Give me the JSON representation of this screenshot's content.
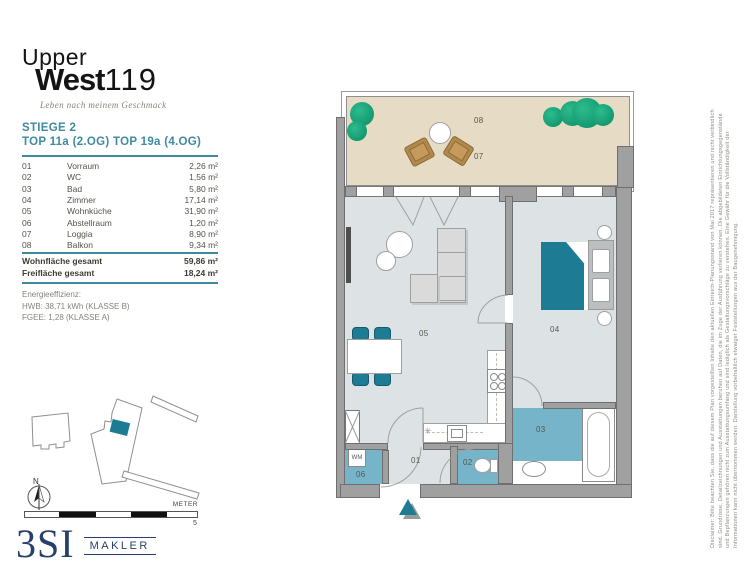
{
  "branding": {
    "word1": "Upper",
    "word2": "West",
    "number": "119",
    "tagline": "Leben nach meinem Geschmack"
  },
  "header": {
    "stiege": "STIEGE 2",
    "top_line": "TOP 11a (2.OG) TOP 19a (4.OG)"
  },
  "room_table": {
    "rows": [
      {
        "no": "01",
        "name": "Vorraum",
        "area": "2,26 m²"
      },
      {
        "no": "02",
        "name": "WC",
        "area": "1,56 m²"
      },
      {
        "no": "03",
        "name": "Bad",
        "area": "5,80 m²"
      },
      {
        "no": "04",
        "name": "Zimmer",
        "area": "17,14 m²"
      },
      {
        "no": "05",
        "name": "Wohnküche",
        "area": "31,90 m²"
      },
      {
        "no": "06",
        "name": "Abstellraum",
        "area": "1,20 m²"
      },
      {
        "no": "07",
        "name": "Loggia",
        "area": "8,90 m²"
      },
      {
        "no": "08",
        "name": "Balkon",
        "area": "9,34 m²"
      }
    ]
  },
  "totals": {
    "rows": [
      {
        "label": "Wohnfläche gesamt",
        "value": "59,86 m²"
      },
      {
        "label": "Freifläche gesamt",
        "value": "18,24 m²"
      }
    ]
  },
  "energy": {
    "title": "Energieeffizienz:",
    "line1": "HWB: 38,71 kWh (KLASSE B)",
    "line2": "FGEE: 1,28 (KLASSE A)"
  },
  "plan_labels": {
    "l01": "01",
    "l02": "02",
    "l03": "03",
    "l04": "04",
    "l05": "05",
    "l06": "06",
    "l07": "07",
    "l08": "08",
    "wm": "WM"
  },
  "compass": {
    "north": "N"
  },
  "scale_bar": {
    "unit": "METER",
    "max": "5"
  },
  "broker": {
    "name": "3SI",
    "suffix": "MAKLER"
  },
  "disclaimer": {
    "line1": "Disclaimer: Bitte beachten Sie, dass die auf diesem Plan vorgestellten Inhalte den aktuellen Einreich-Planungsstand von Mai 2017 repräsentieren und nicht verbindlich",
    "line2": "sind. Grundrisse, Detailzeichnungen und Ausstattungen beruhen auf Daten, die im Zuge der Ausführung verlieren können. Die abgebildeten Einrichtungsgegenstände",
    "line3": "und Bepflanzungen gehören nicht zum Ausstattungsumfang und sind lediglich als Gestaltungsvorschläge zu verstehen. Eine Gewähr für die Vollständigkeit der",
    "line4": "Informationen kann nicht übernommen werden. Darstellung vorbehaltlich etwaiger Feststellungen aus der Baugenehmigung."
  },
  "colors": {
    "accent_teal": "#3f8a9e",
    "wet_room": "#76b5c9",
    "furniture_teal": "#1d7b93",
    "floor": "#dde3e4",
    "balcony": "#e6dcc5",
    "wall": "#a0a0a0",
    "wall_edge": "#6f6f6f",
    "tree": "#12a377",
    "wood": "#b1894d",
    "navy": "#27406b",
    "label": "#57574e"
  }
}
